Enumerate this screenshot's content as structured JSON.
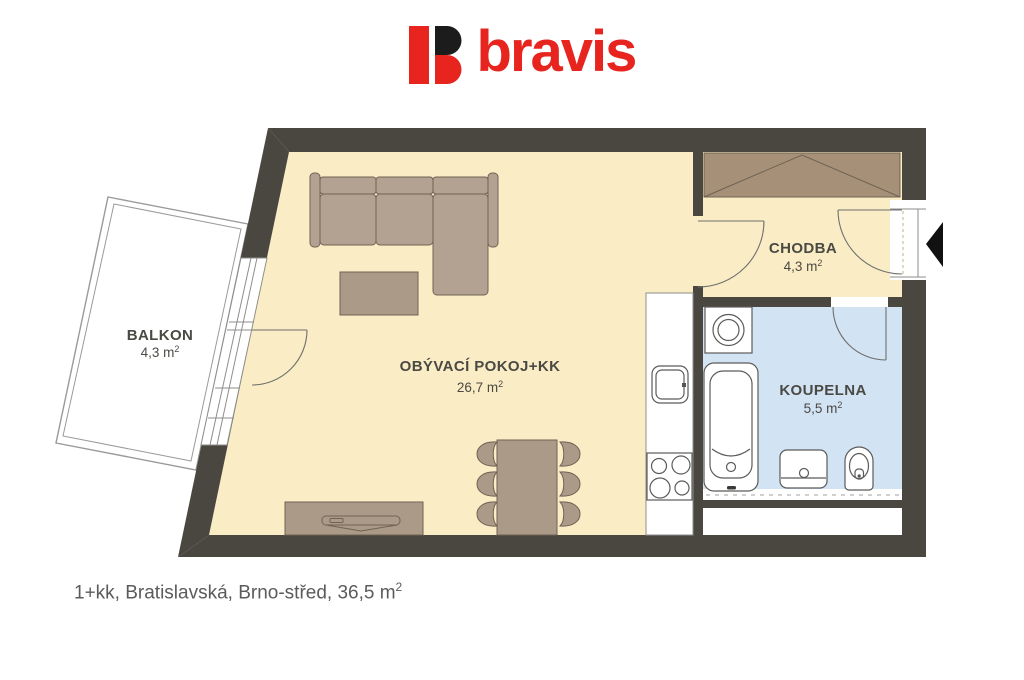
{
  "logo": {
    "brand": "bravis"
  },
  "rooms": {
    "balkon": {
      "name": "BALKON",
      "area": "4,3 m",
      "sup": "2"
    },
    "living": {
      "name": "OBÝVACÍ POKOJ+KK",
      "area": "26,7 m",
      "sup": "2"
    },
    "chodba": {
      "name": "CHODBA",
      "area": "4,3 m",
      "sup": "2"
    },
    "koupelna": {
      "name": "KOUPELNA",
      "area": "5,5 m",
      "sup": "2"
    }
  },
  "caption": {
    "text": "1+kk, Bratislavská, Brno-střed, 36,5 m",
    "sup": "2"
  },
  "colors": {
    "brand_red": "#E8241F",
    "brand_dark": "#1C1C1C",
    "wall": "#49473F",
    "floor": "#FAEDC5",
    "bath_floor": "#D2E3F4",
    "sofa": "#B3A292",
    "wood": "#AB9A87",
    "wardrobe": "#A69178",
    "outline": "#6F6253",
    "label": "#4A4944"
  }
}
